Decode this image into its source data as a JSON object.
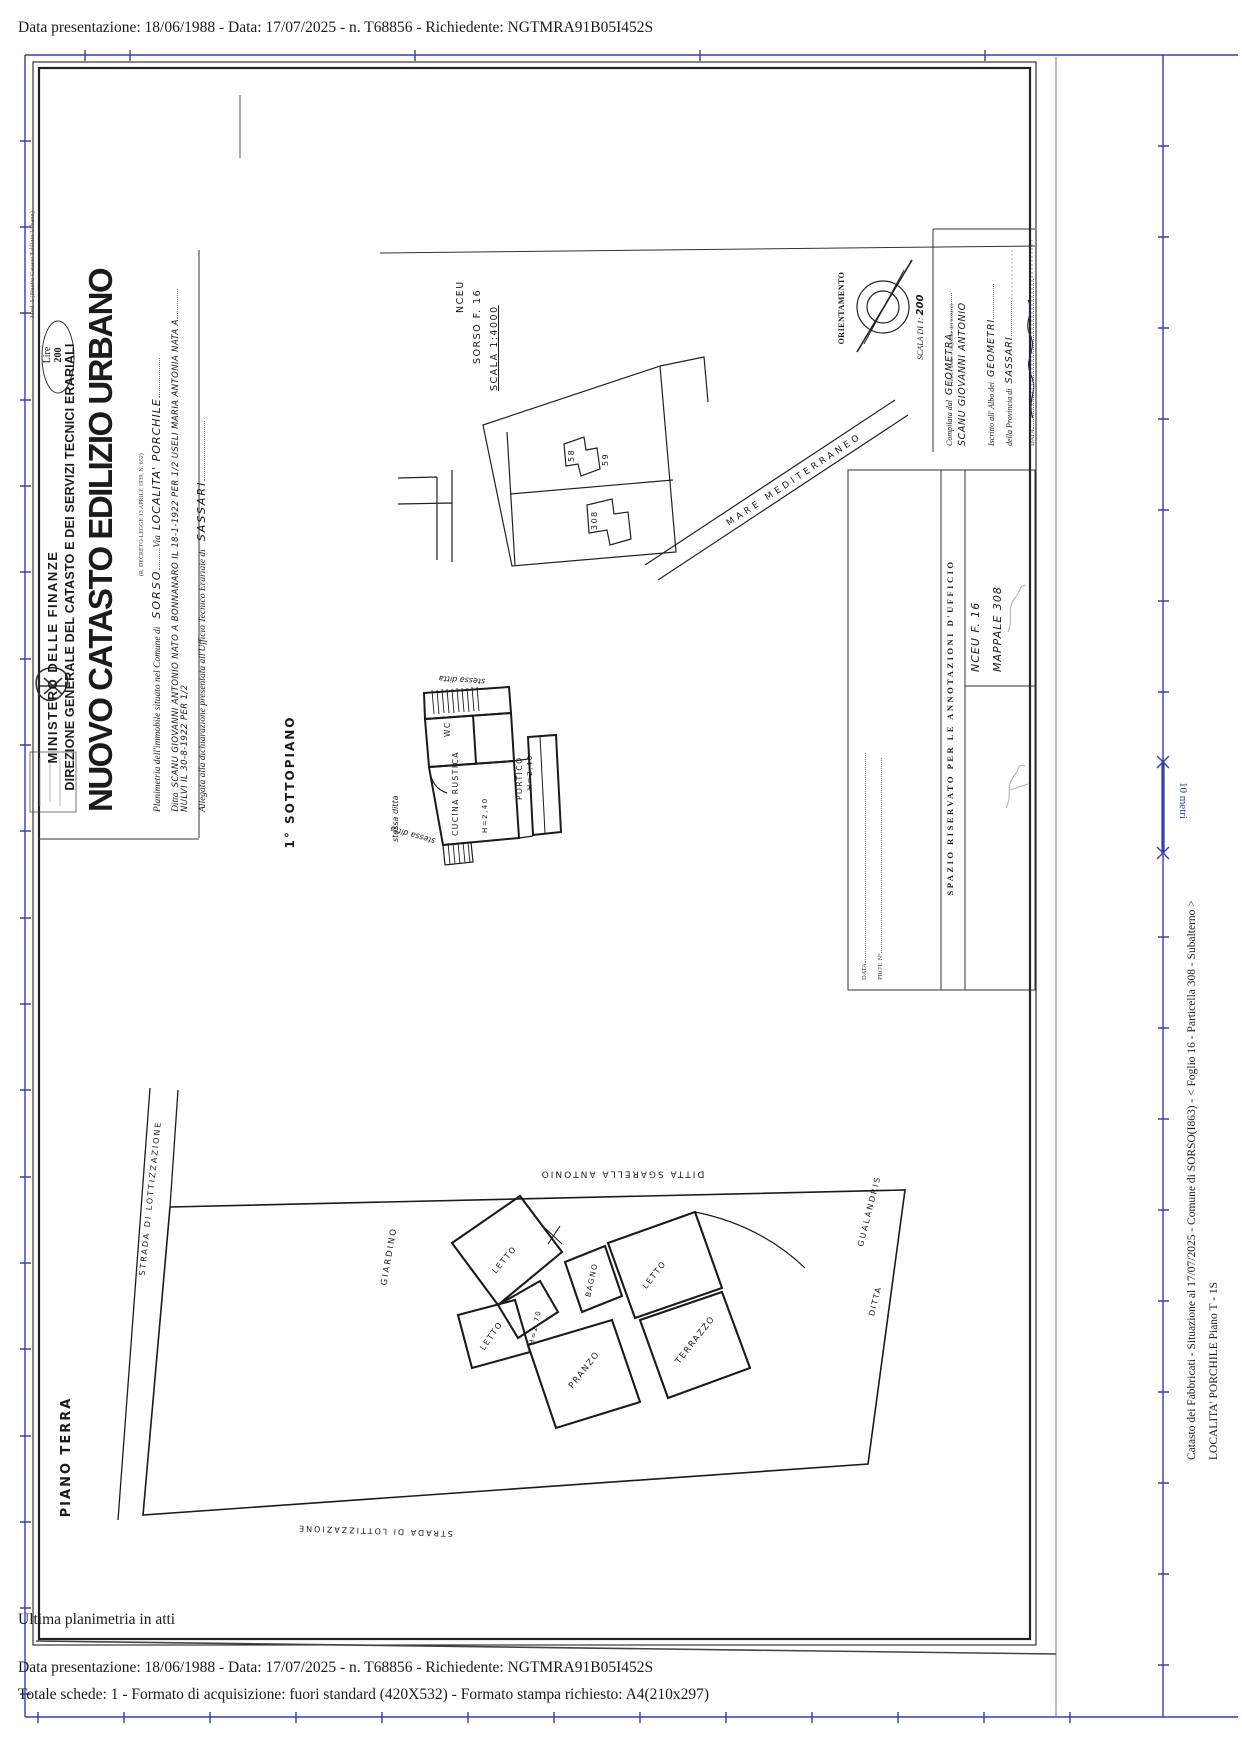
{
  "page": {
    "title_line": "Data presentazione: 18/06/1988 - Data: 17/07/2025 - n. T68856 - Richiedente: NGTMRA91B05I452S",
    "footer_note": "Ultima planimetria in atti",
    "footer_line1": "Data presentazione: 18/06/1988 - Data: 17/07/2025 - n. T68856 - Richiedente: NGTMRA91B05I452S",
    "footer_line2": "Totale schede: 1 - Formato di acquisizione: fuori standard (420X532) - Formato stampa richiesto: A4(210x297)"
  },
  "viewer": {
    "side_line1": "Catasto dei Fabbricati - Situazione al 17/07/2025 - Comune di SORSO(I863) - < Foglio 16 - Particella 308 - Subalterno >",
    "side_line2": "LOCALITA' PORCHILE Piano T - 1S",
    "ruler_label": "10 metri"
  },
  "form": {
    "mod": "Mod. 5 (Nuovo Catasto Edilizio Urbano)",
    "stamp_line1": "Lire",
    "stamp_line2": "200",
    "ministry": "MINISTERO DELLE FINANZE",
    "direzione": "DIREZIONE GENERALE DEL CATASTO E DEI SERVIZI TECNICI ERARIALI",
    "title": "NUOVO CATASTO EDILIZIO URBANO",
    "decree": "(R. DECRETO-LEGGE 13 APRILE 1939, N. 652)",
    "planimetria_label": "Planimetria dell'immobile situato nel Comune di",
    "comune": "SORSO",
    "via_label": "Via",
    "via_value": "LOCALITA'  PORCHILE",
    "ditta_label": "Ditta",
    "ditta_value": "SCANU GIOVANNI ANTONIO NATO A BONNANARO IL 18-1-1922 PER 1/2 USELI MARIA ANTONIA NATA A",
    "ditta_value2": "NULVI IL 30-8-1922 PER 1/2",
    "allegata_label": "Allegata alla dichiarazione presentata all'Ufficio Tecnico Erariale di",
    "ufficio": "SASSARI"
  },
  "site_plan": {
    "nceu": "NCEU",
    "foglio": "SORSO  F. 16",
    "scala": "SCALA 1:4000",
    "parcel_58": "58",
    "parcel_59": "59",
    "parcel_308": "308",
    "sea": "MARE  MEDITERRANEO"
  },
  "compass": {
    "label": "ORIENTAMENTO",
    "scala_label": "SCALA DI 1:",
    "scala_value": "200"
  },
  "geometra": {
    "compilata_label": "Compilata dal",
    "compilata_value": "GEOMETRA",
    "subtitle": "(Titolo, nome e cognome del tecnico)",
    "nome": "SCANU GIOVANNI ANTONIO",
    "albo_label": "Iscritto all' Albo dei",
    "albo_value": "GEOMETRI",
    "provincia_label": "della Provincia di",
    "provincia_value": "SASSARI",
    "data_label": "DATA"
  },
  "annotazioni": {
    "header": "SPAZIO RISERVATO PER LE ANNOTAZIONI D'UFFICIO",
    "nceu": "NCEU   F. 16",
    "mappale": "MAPPALE 308",
    "data_label": "DATA",
    "prot_label": "PROT. N°"
  },
  "sottopiano": {
    "title": "1° SOTTOPIANO",
    "wc": "WC",
    "cucina": "CUCINA RUSTICA",
    "portico": "PORTICO",
    "h1": "H=2,40",
    "h2": "H=2,40",
    "stessa1": "stessa ditta",
    "stessa2": "stessa ditta",
    "stessa3": "stessa ditta"
  },
  "piano_terra": {
    "title": "PIANO TERRA",
    "strada_left": "STRADA DI LOTTIZZAZIONE",
    "strada_bottom": "STRADA  DI  LOTTIZZAZIONE",
    "giardino": "GIARDINO",
    "ditta_top": "DITTA   SGARELLA   ANTONIO",
    "gualandris": "GUALANDRIS",
    "ditta_right": "DITTA",
    "letto1": "LETTO",
    "letto2": "LETTO",
    "letto3": "LETTO",
    "bagno": "BAGNO",
    "pranzo": "PRANZO",
    "terrazzo": "TERRAZZO",
    "h": "H=2,70"
  }
}
